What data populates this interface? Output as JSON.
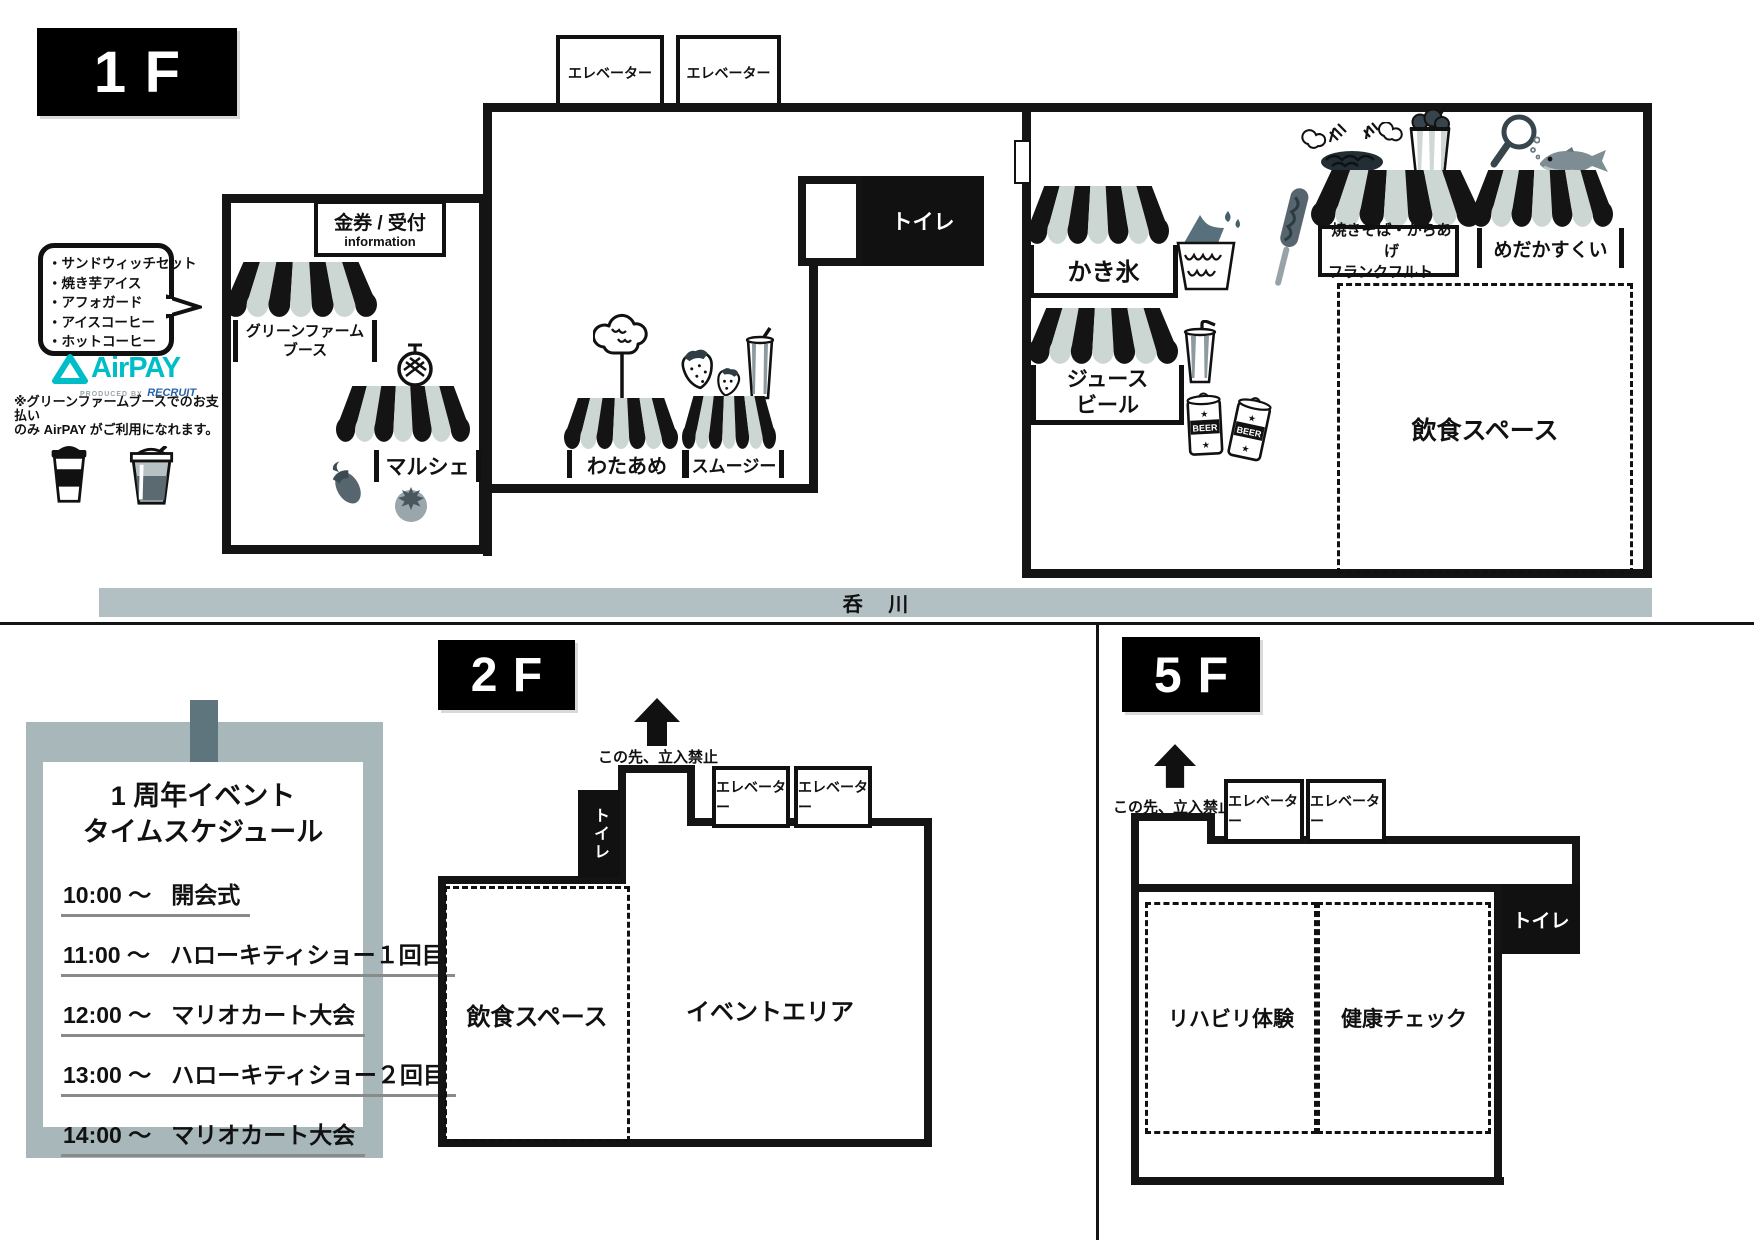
{
  "common": {
    "elevator_label": "エレベーター",
    "toilet_label": "トイレ",
    "no_entry_label": "この先、立入禁止",
    "dining_space_label": "飲食スペース"
  },
  "floor1": {
    "label": "1F",
    "reception_title": "金券 / 受付",
    "reception_subtitle": "information",
    "menu_bubble_items": [
      "・サンドウィッチセット",
      "・焼き芋アイス",
      "・アフォガード",
      "・アイスコーヒー",
      "・ホットコーヒー"
    ],
    "airpay_brand": "AirPAY",
    "airpay_produced_by": "PRODUCED BY",
    "airpay_recruit": "RECRUIT",
    "airpay_note_line1": "※グリーンファームブースでのお支払い",
    "airpay_note_line2": "のみ AirPAY がご利用になれます。",
    "stall_green_farm_line1": "グリーンファーム",
    "stall_green_farm_line2": "ブース",
    "stall_marche": "マルシェ",
    "stall_cotton_candy": "わたあめ",
    "stall_smoothie": "スムージー",
    "stall_shaved_ice": "かき氷",
    "stall_juice_line1": "ジュース",
    "stall_juice_line2": "ビール",
    "stall_yakisoba_line1": "焼きそば・からあげ",
    "stall_yakisoba_line2": "フランクフルト",
    "stall_medaka": "めだかすくい",
    "beer_can_label": "BEER",
    "river_label": "呑 川"
  },
  "floor2": {
    "label": "2F",
    "event_area_label": "イベントエリア",
    "poster": {
      "title_line1": "1 周年イベント",
      "title_line2": "タイムスケジュール",
      "schedule": [
        {
          "time": "10:00 ～",
          "event": "開会式"
        },
        {
          "time": "11:00 ～",
          "event": "ハローキティショー１回目"
        },
        {
          "time": "12:00 ～",
          "event": "マリオカート大会"
        },
        {
          "time": "13:00 ～",
          "event": "ハローキティショー２回目"
        },
        {
          "time": "14:00 ～",
          "event": "マリオカート大会"
        }
      ]
    }
  },
  "floor5": {
    "label": "5F",
    "rehab_label": "リハビリ体験",
    "health_check_label": "健康チェック"
  },
  "colors": {
    "awning_light": "#ccd6d2",
    "ink": "#141414",
    "river_fill": "#b2c0c3",
    "poster_bg": "#a7b7ba",
    "poster_tab": "#5f757e",
    "airpay_teal": "#00bec8",
    "recruit_blue": "#2b63a8"
  },
  "icons": [
    "melon-icon",
    "eggplant-icon",
    "tomato-icon",
    "cotton-candy-icon",
    "strawberry-icon",
    "smoothie-cup-icon",
    "shaved-ice-icon",
    "corn-dog-icon",
    "yakisoba-icon",
    "karaage-bucket-icon",
    "scoop-net-icon",
    "medaka-fish-icon",
    "juice-cup-icon",
    "beer-cans-icon",
    "coffee-cup-icon",
    "takeout-drink-icon",
    "up-arrow-icon"
  ]
}
